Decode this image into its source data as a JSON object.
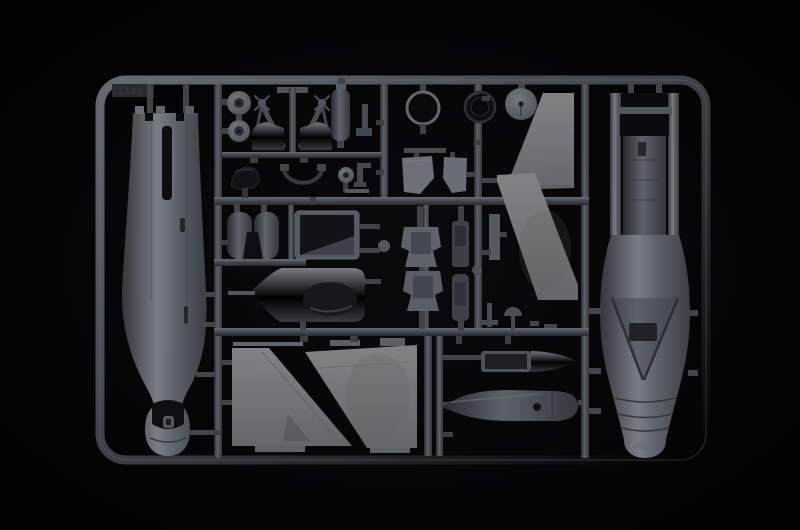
{
  "meta": {
    "type": "photograph",
    "subject": "Injection-molded grey styrene model kit sprue of a jet aircraft, photographed on a black background",
    "background_color": "#000000",
    "plastic_base_color": "#7d838b",
    "runner_color": "#5d636b",
    "highlight_color": "#a6acb4",
    "shadow_color": "#34383e"
  },
  "sprue": {
    "mold_stamp": "1389",
    "frame_shape": "rounded-rectangle frame with internal runner grid",
    "parts": [
      {
        "name": "left-fuselage-half",
        "desc": "long vertical fuselage half, castellated tail at top, rounded nose at bottom"
      },
      {
        "name": "right-fuselage-half",
        "desc": "long vertical fuselage half with dark exhaust opening, afterburner bands, cockpit opening and V panel"
      },
      {
        "name": "main-wheel-1",
        "desc": "round wheel with hub hole"
      },
      {
        "name": "main-wheel-2",
        "desc": "round wheel with hub hole"
      },
      {
        "name": "landing-gear-struts",
        "desc": "mirrored pair of landing gear legs with fenders on central post"
      },
      {
        "name": "fuel-tank-cylinder",
        "desc": "small vertical cylinder with cap"
      },
      {
        "name": "bracket-part",
        "desc": "small L-shaped bracket"
      },
      {
        "name": "dark-canopy-part",
        "desc": "small dark curved blister part"
      },
      {
        "name": "hose-part",
        "desc": "U-shaped hose with end fittings"
      },
      {
        "name": "nose-wheel",
        "desc": "small wheel with hub"
      },
      {
        "name": "faucet-bracket",
        "desc": "small T-shaped fitting"
      },
      {
        "name": "intake-ring",
        "desc": "thin open circular ring"
      },
      {
        "name": "tire",
        "desc": "dark rubber-looking tire ring"
      },
      {
        "name": "wheel-disc",
        "desc": "solid grey disc with center hole"
      },
      {
        "name": "intake-ramp-1",
        "desc": "small trapezoid splitter plate"
      },
      {
        "name": "intake-ramp-2",
        "desc": "small trapezoid splitter plate"
      },
      {
        "name": "intake-trunk-halves",
        "desc": "two half-cylinder duct parts with dark gap"
      },
      {
        "name": "intake-duct-box",
        "desc": "open box duct with dark interior and angled floor"
      },
      {
        "name": "nose-spine-with-probe",
        "desc": "rounded body with dark oval opening and long thin pitot probe"
      },
      {
        "name": "ejection-seat-half-1",
        "desc": "bucket-shaped seat part"
      },
      {
        "name": "ejection-seat-half-2",
        "desc": "bucket-shaped seat part"
      },
      {
        "name": "seat-back-1",
        "desc": "narrow rectangular seat back"
      },
      {
        "name": "seat-back-2",
        "desc": "narrow rectangular seat back"
      },
      {
        "name": "wing-leading-edge-upper",
        "desc": "light grey swept triangular panel"
      },
      {
        "name": "wing-leading-edge-lower",
        "desc": "large light grey swept band panel"
      },
      {
        "name": "tail-fin-left-half",
        "desc": "large light grey fin half with diagonal trailing edge"
      },
      {
        "name": "tail-fin-right-half",
        "desc": "large light grey fin half, parallelogram with diagonal leading edge"
      },
      {
        "name": "nose-cone-upper-half",
        "desc": "horizontal cone half with open trough"
      },
      {
        "name": "nose-cone-lower-half",
        "desc": "horizontal pointed cone half with round opening"
      },
      {
        "name": "small-antenna-parts",
        "desc": "assorted tiny struts, T-parts and fittings"
      }
    ]
  }
}
